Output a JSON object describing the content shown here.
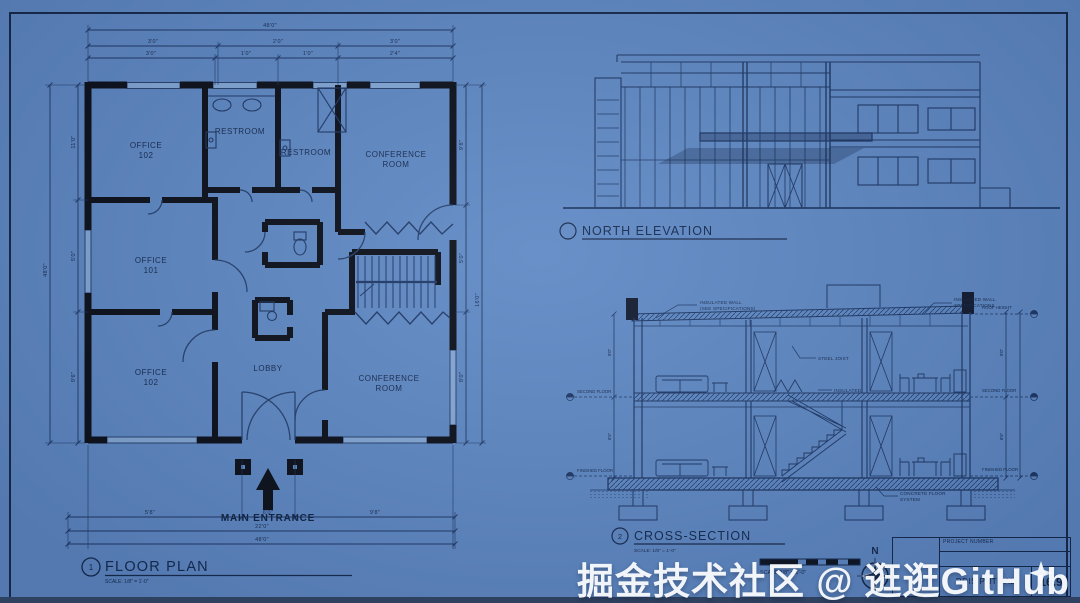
{
  "colors": {
    "paper": "#5e88c4",
    "ink": "#1d3765",
    "wall": "#0a0e18",
    "text": "#13294e",
    "white": "#fbfdff"
  },
  "watermark": {
    "text": "掘金技术社区 @ 逛逛GitHub"
  },
  "floor_plan": {
    "callout": "1",
    "title": "FLOOR PLAN",
    "scale": "SCALE: 1/8\" = 1'-0\"",
    "entrance": "MAIN ENTRANCE",
    "rooms": [
      {
        "l1": "OFFICE",
        "l2": "102"
      },
      {
        "l1": "RESTROOM",
        "l2": ""
      },
      {
        "l1": "RESTROOM",
        "l2": ""
      },
      {
        "l1": "CONFERENCE",
        "l2": "ROOM"
      },
      {
        "l1": "OFFICE",
        "l2": "101"
      },
      {
        "l1": "OFFICE",
        "l2": "102"
      },
      {
        "l1": "LOBBY",
        "l2": ""
      },
      {
        "l1": "CONFERENCE",
        "l2": "ROOM"
      }
    ],
    "dims": {
      "top_overall": "48'0\"",
      "top2": [
        "3'0\"",
        "2'0\"",
        "3'0\""
      ],
      "top3": [
        "3'0\"",
        "1'0\"",
        "1'0\"",
        "2'4\""
      ],
      "bottom1": [
        "5'8\"",
        "6'0\"",
        "9'8\""
      ],
      "bottom2": "22'0\"",
      "bottom3": "48'0\"",
      "left": [
        "11'0\"",
        "5'0\"",
        "9'6\""
      ],
      "left_overall": "48'0\"",
      "right": [
        "9'8\"",
        "5'0\"",
        "8'0\""
      ],
      "right_overall": "16'0\""
    }
  },
  "elevation": {
    "title": "NORTH ELEVATION"
  },
  "section": {
    "callout": "2",
    "title": "CROSS-SECTION",
    "scale": "SCALE: 1/8\" = 1'-0\"",
    "ann": {
      "wall_left1": "INSULATED WALL",
      "wall_left2": "(SEE SPECIFICATIONS)",
      "wall_right1": "INSULATED WALL",
      "wall_right2": "SPECIFICATIONS",
      "joist": "STEEL JOIST",
      "insulated": "INSULATED",
      "floor1": "CONCRETE FLOOR",
      "floor2": "SYSTEM"
    },
    "levels": {
      "left_mid": "SECOND FLOOR",
      "left_low": "FINISHED FLOOR",
      "right_top": "ROOF HEIGHT",
      "right_mid": "SECOND FLOOR",
      "right_low": "FINISHED FLOOR"
    },
    "dims": {
      "left": [
        "8'0\"",
        "8'6\""
      ],
      "right": [
        "8'0\"",
        "8'6\""
      ]
    }
  },
  "sheet": {
    "north": "N",
    "scalebar": "SCALE 1/8\" = 1'-0\"",
    "titleblock": {
      "header": "PROJECT NUMBER",
      "name": "RDIS PNTMAL",
      "number": "16.9"
    }
  }
}
